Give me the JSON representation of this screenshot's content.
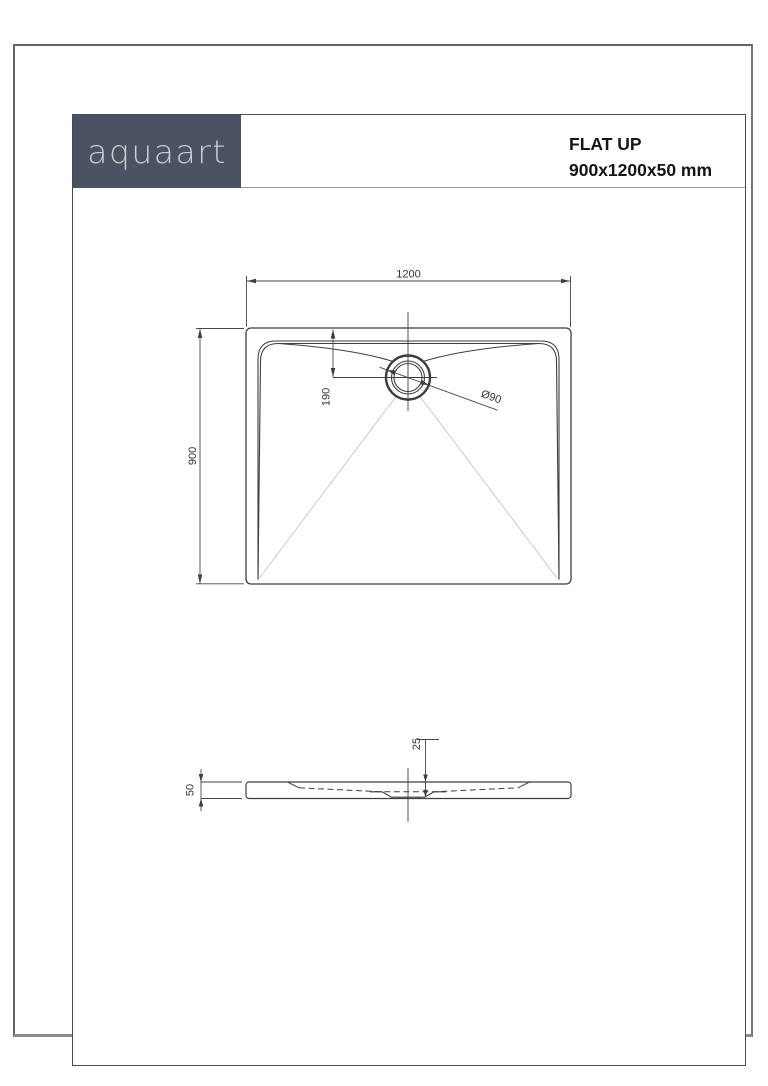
{
  "header": {
    "brand": "aquaart",
    "product_line1": "FLAT UP",
    "product_line2": "900x1200x50 mm",
    "logo_bg": "#4a5364",
    "logo_text_color": "#c9d0ce"
  },
  "drawing": {
    "plan": {
      "width_label": "1200",
      "height_label": "900",
      "drain_offset_label": "190",
      "drain_diameter_label": "Ø90"
    },
    "section": {
      "height_label": "50",
      "depth_label": "25"
    },
    "colors": {
      "line": "#3e3e3e",
      "dimension_line": "#474747",
      "slope_line": "#c9c9c9"
    }
  }
}
